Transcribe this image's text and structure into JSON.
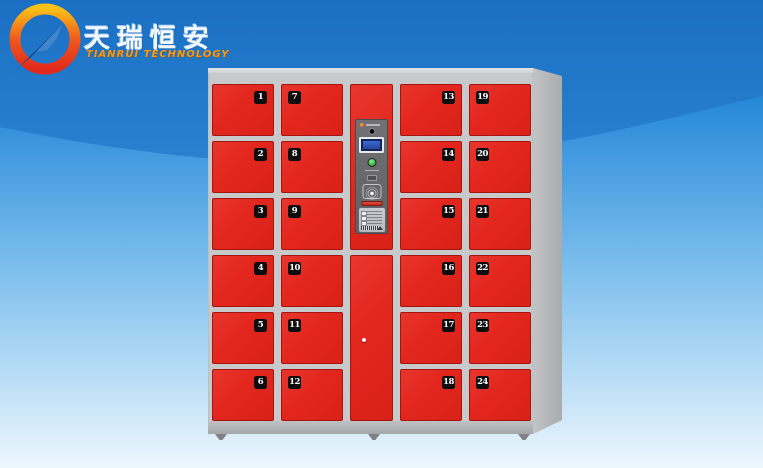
{
  "brand": {
    "chinese_name": "天瑞恒安",
    "english_name": "TIANRUI TECHNOLOGY",
    "logo_ring_colors": [
      "#fbbf16",
      "#e8401e",
      "#e22b1d"
    ],
    "logo_arrow_color": "#1c5dad"
  },
  "background": {
    "sky_top": "#1a6fc2",
    "sky_bottom": "#46a3ea",
    "wave_top": "#2487d8",
    "wave_bottom": "#ecf7fd"
  },
  "locker": {
    "door_color": "#e3271f",
    "frame_color": "#c8c9cb",
    "door_count": 24,
    "columns": [
      {
        "id": "column-1",
        "badge_side": "right",
        "doors": [
          "1",
          "2",
          "3",
          "4",
          "5",
          "6"
        ]
      },
      {
        "id": "column-2",
        "badge_side": "left",
        "doors": [
          "7",
          "8",
          "9",
          "10",
          "11",
          "12"
        ]
      },
      {
        "id": "column-center",
        "type": "control",
        "doors": []
      },
      {
        "id": "column-3",
        "badge_side": "right",
        "doors": [
          "13",
          "14",
          "15",
          "16",
          "17",
          "18"
        ]
      },
      {
        "id": "column-4",
        "badge_side": "left",
        "doors": [
          "19",
          "20",
          "21",
          "22",
          "23",
          "24"
        ]
      }
    ],
    "control_panel": {
      "elements": [
        "panel-brand-icon",
        "camera-icon",
        "lcd-screen",
        "green-led-indicator",
        "barcode-scanner-window",
        "rfid-reader-icon",
        "ticket-slot",
        "instruction-sticker"
      ],
      "screen_color": "#14245c",
      "led_color": "#2aa832"
    }
  }
}
